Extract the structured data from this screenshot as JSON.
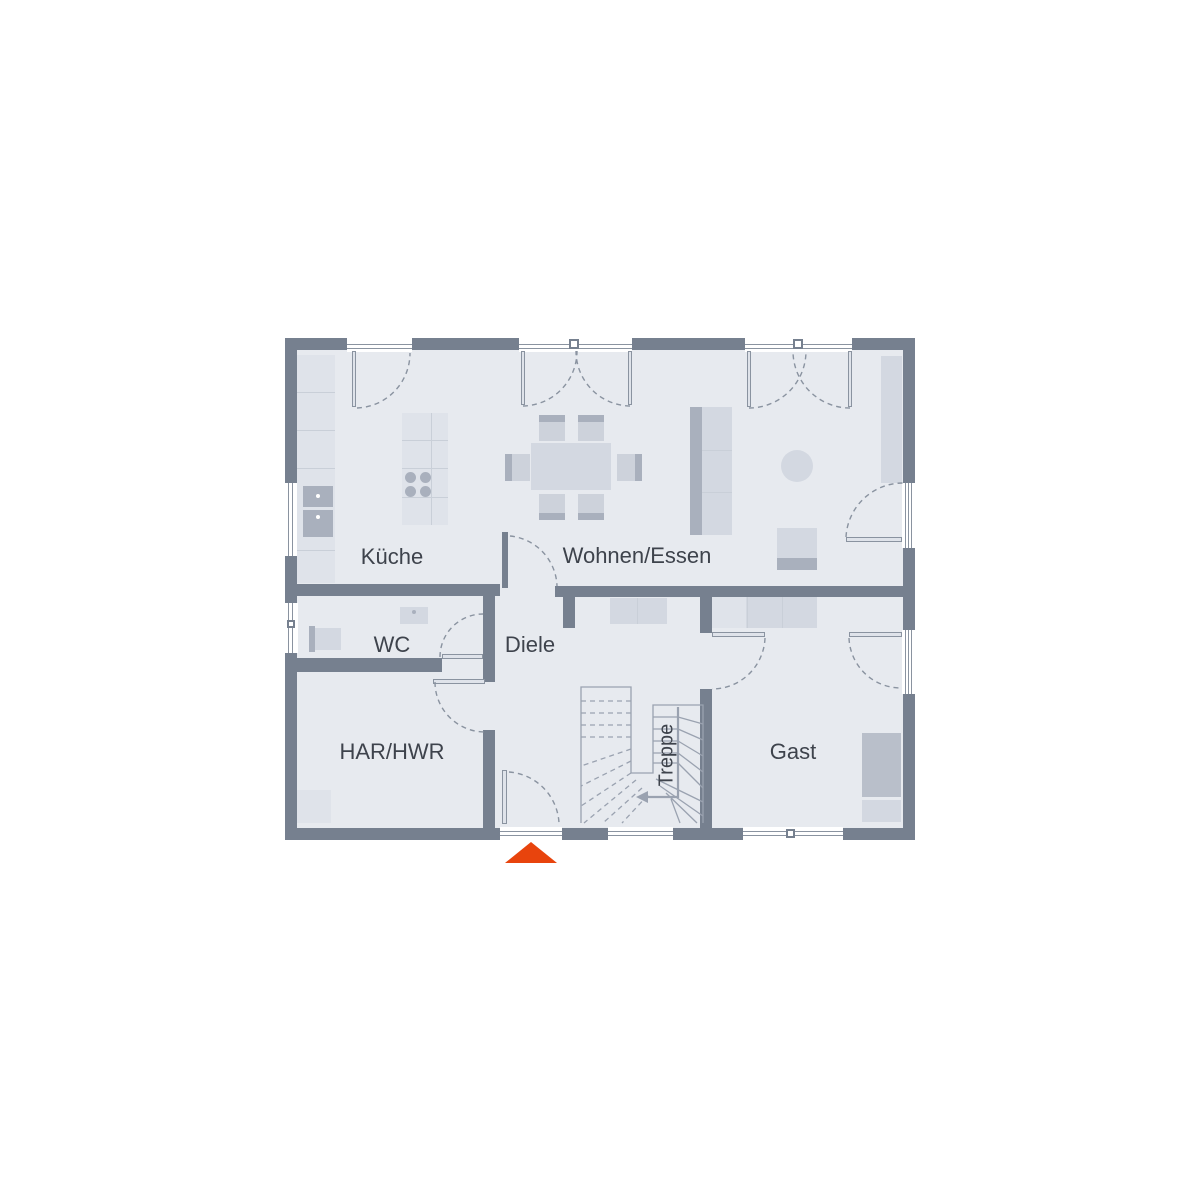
{
  "plan": {
    "type": "floor-plan",
    "rooms": {
      "kueche": {
        "label": "Küche"
      },
      "wohnen": {
        "label": "Wohnen/Essen"
      },
      "wc": {
        "label": "WC"
      },
      "diele": {
        "label": "Diele"
      },
      "har": {
        "label": "HAR/HWR"
      },
      "gast": {
        "label": "Gast"
      },
      "treppe": {
        "label": "Treppe"
      }
    },
    "markers": {
      "entrance": {
        "shape": "triangle-up",
        "color": "#E8440D"
      }
    }
  },
  "colors": {
    "wall": "#76808F",
    "floor": "#E7EAEF",
    "line": "#8A93A0",
    "stair-line": "#9AA2B0",
    "furn-light": "#DFE3EA",
    "furn-mid": "#D3D8E1",
    "furn-dark": "#A9B0BD",
    "chair-seat": "#CDD2DB",
    "divider": "#C9CFD8",
    "bed": "#B9BFCA",
    "text": "#3E434C",
    "accent": "#E8440D",
    "window": "#FFFFFF"
  }
}
